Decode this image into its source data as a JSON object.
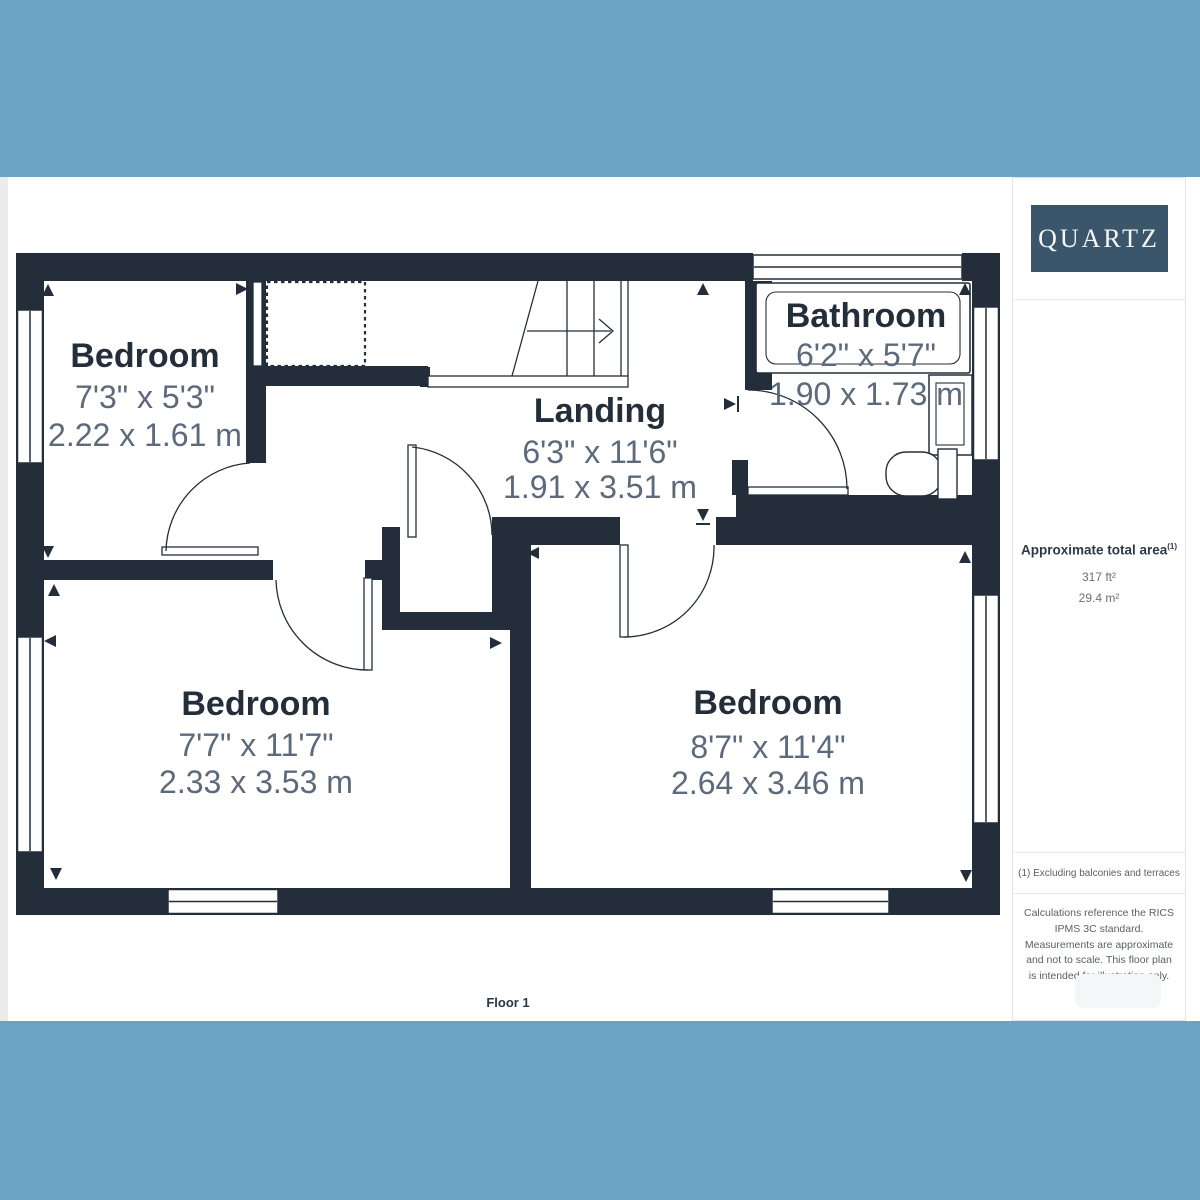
{
  "frame": {
    "blue": "#6ba3c4",
    "wall_color": "#242e3b"
  },
  "plan": {
    "rooms": [
      {
        "id": "bedroom-top-left",
        "name": "Bedroom",
        "imperial": "7'3\" x 5'3\"",
        "metric": "2.22 x 1.61 m"
      },
      {
        "id": "landing",
        "name": "Landing",
        "imperial": "6'3\" x 11'6\"",
        "metric": "1.91 x 3.51 m"
      },
      {
        "id": "bathroom",
        "name": "Bathroom",
        "imperial": "6'2\" x 5'7\"",
        "metric": "1.90 x 1.73 m"
      },
      {
        "id": "bedroom-bottom-left",
        "name": "Bedroom",
        "imperial": "7'7\" x 11'7\"",
        "metric": "2.33 x 3.53 m"
      },
      {
        "id": "bedroom-bottom-right",
        "name": "Bedroom",
        "imperial": "8'7\" x 11'4\"",
        "metric": "2.64 x 3.46 m"
      }
    ],
    "floor_label": "Floor 1"
  },
  "sidebar": {
    "logo_text": "QUARTZ",
    "area_title": "Approximate total area",
    "area_footnote_marker": "(1)",
    "area_imperial": "317 ft²",
    "area_metric": "29.4 m²",
    "footnote": "(1) Excluding balconies and terraces",
    "disclaimer": "Calculations reference the RICS IPMS 3C standard. Measurements are approximate and not to scale. This floor plan is intended for illustration only."
  }
}
